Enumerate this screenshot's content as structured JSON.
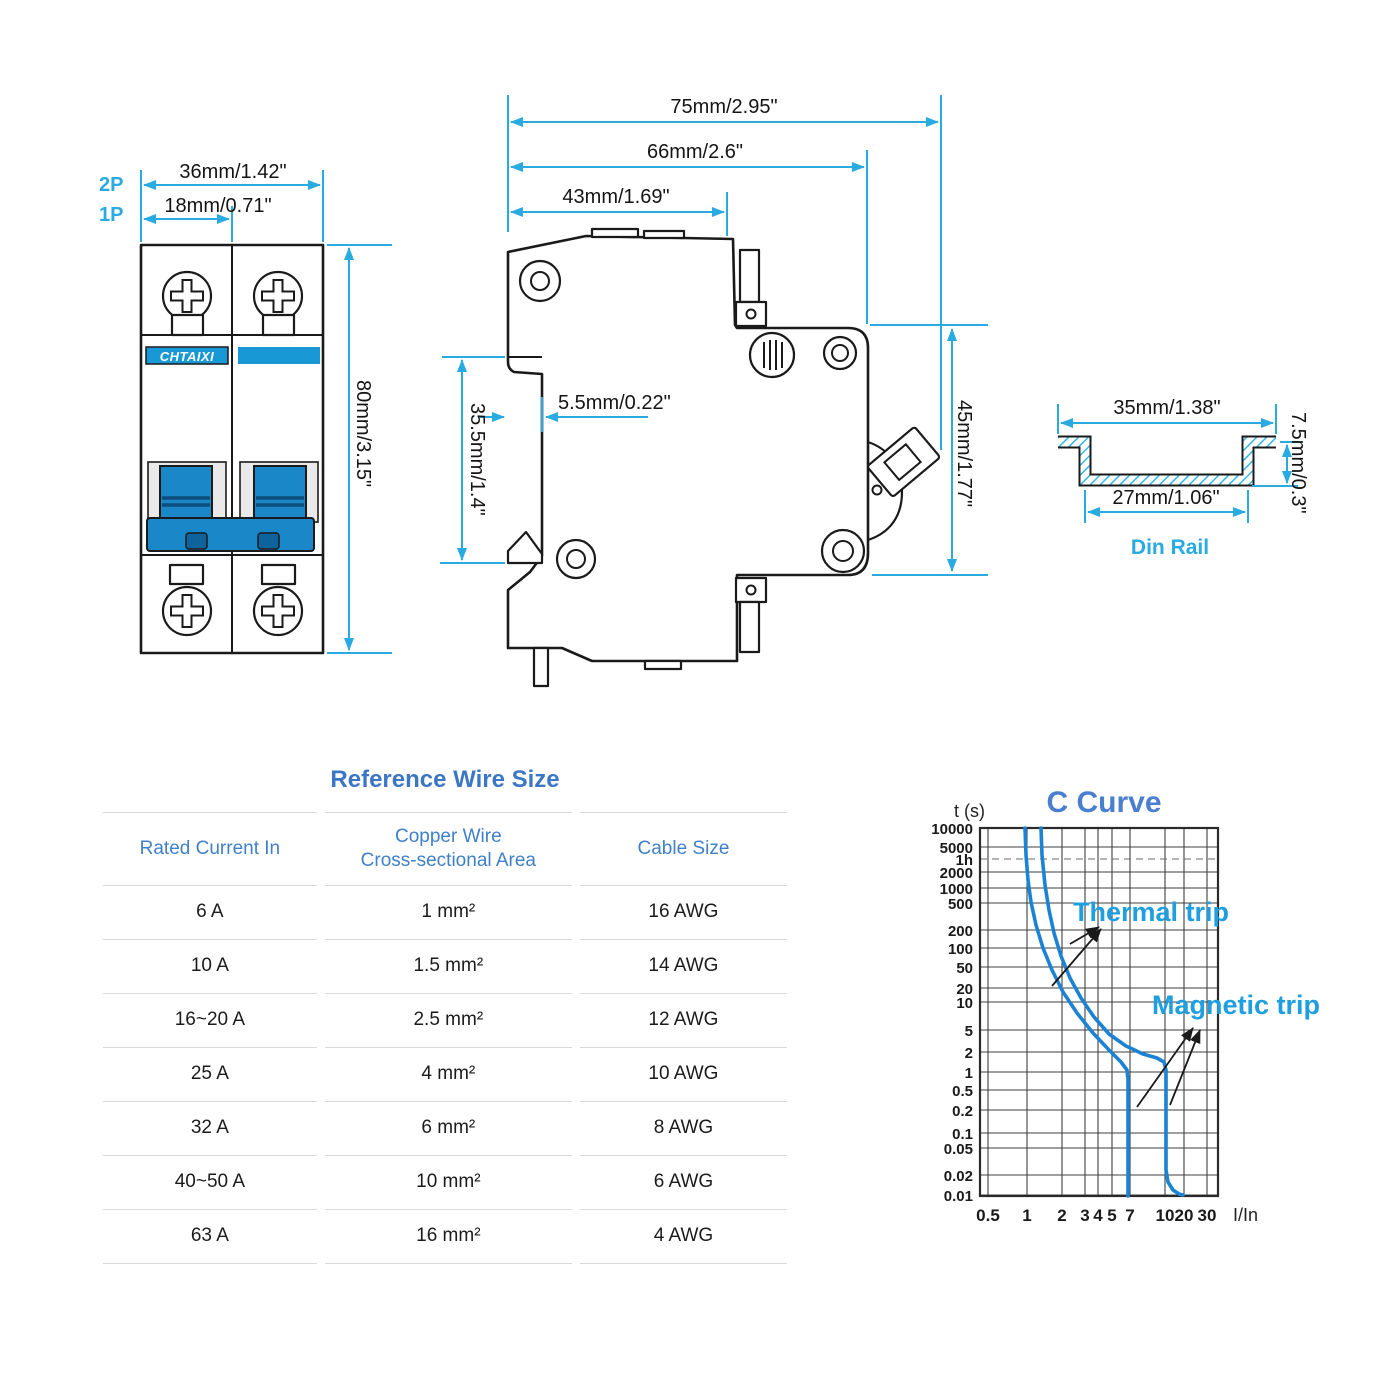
{
  "front_view": {
    "pole_labels": {
      "p2": "2P",
      "p1": "1P"
    },
    "brand": "CHTAIXI",
    "dims": {
      "width_2p": "36mm/1.42\"",
      "width_1p": "18mm/0.71\"",
      "height": "80mm/3.15\""
    }
  },
  "side_view": {
    "dims": {
      "total_width": "75mm/2.95\"",
      "body_width": "66mm/2.6\"",
      "front_width": "43mm/1.69\"",
      "recess_depth": "5.5mm/0.22\"",
      "recess_height": "35.5mm/1.4\"",
      "body_height": "45mm/1.77\""
    }
  },
  "din_rail": {
    "label": "Din Rail",
    "dims": {
      "outer_width": "35mm/1.38\"",
      "inner_width": "27mm/1.06\"",
      "depth": "7.5mm/0.3\""
    }
  },
  "wire_table": {
    "title": "Reference Wire Size",
    "headers": [
      "Rated Current In",
      "Copper Wire\nCross-sectional Area",
      "Cable Size"
    ],
    "rows": [
      [
        "6 A",
        "1 mm²",
        "16 AWG"
      ],
      [
        "10 A",
        "1.5 mm²",
        "14 AWG"
      ],
      [
        "16~20 A",
        "2.5 mm²",
        "12 AWG"
      ],
      [
        "25 A",
        "4 mm²",
        "10 AWG"
      ],
      [
        "32 A",
        "6 mm²",
        "8 AWG"
      ],
      [
        "40~50 A",
        "10 mm²",
        "6 AWG"
      ],
      [
        "63 A",
        "16 mm²",
        "4 AWG"
      ]
    ]
  },
  "chart_data": {
    "type": "line",
    "title": "C Curve",
    "ylabel": "t (s)",
    "xlabel": "I/In",
    "x_scale": "log",
    "y_scale": "log",
    "xlim": [
      0.5,
      40
    ],
    "ylim": [
      0.01,
      10000
    ],
    "grid": true,
    "annotations": [
      "Thermal trip",
      "Magnetic trip"
    ],
    "description": "MCB C-curve trip characteristic: tripping time vs multiples of rated current. Thermal trip region between the two curves; magnetic (instantaneous) trip between roughly 5x and 10x In.",
    "frame_px": {
      "x0": 980,
      "y0": 828,
      "x1": 1218,
      "y1": 1196
    },
    "x_ticks": [
      {
        "label": "0.5",
        "px": 988
      },
      {
        "label": "1",
        "px": 1027
      },
      {
        "label": "2",
        "px": 1062
      },
      {
        "label": "3",
        "px": 1085
      },
      {
        "label": "4",
        "px": 1098
      },
      {
        "label": "5",
        "px": 1112
      },
      {
        "label": "7",
        "px": 1130
      },
      {
        "label": "10",
        "px": 1165
      },
      {
        "label": "20",
        "px": 1184
      },
      {
        "label": "30",
        "px": 1207
      }
    ],
    "y_ticks": [
      {
        "label": "10000",
        "py": 828
      },
      {
        "label": "5000",
        "py": 847
      },
      {
        "label": "1h",
        "py": 859,
        "dashed": true
      },
      {
        "label": "2000",
        "py": 872
      },
      {
        "label": "1000",
        "py": 888
      },
      {
        "label": "500",
        "py": 903
      },
      {
        "label": "200",
        "py": 930
      },
      {
        "label": "100",
        "py": 948
      },
      {
        "label": "50",
        "py": 967
      },
      {
        "label": "20",
        "py": 988
      },
      {
        "label": "10",
        "py": 1002
      },
      {
        "label": "5",
        "py": 1030
      },
      {
        "label": "2",
        "py": 1052
      },
      {
        "label": "1",
        "py": 1072
      },
      {
        "label": "0.5",
        "py": 1090
      },
      {
        "label": "0.2",
        "py": 1110
      },
      {
        "label": "0.1",
        "py": 1133
      },
      {
        "label": "0.05",
        "py": 1148
      },
      {
        "label": "0.02",
        "py": 1175
      },
      {
        "label": "0.01",
        "py": 1195
      }
    ],
    "series": [
      {
        "name": "trip boundary lower (fast)",
        "approx_values": [
          [
            1,
            10000
          ],
          [
            1.3,
            1000
          ],
          [
            1.8,
            100
          ],
          [
            2.6,
            20
          ],
          [
            4,
            4
          ],
          [
            5.5,
            1
          ],
          [
            5.5,
            0.01
          ]
        ],
        "points_px": [
          [
            1025,
            828
          ],
          [
            1026,
            855
          ],
          [
            1028,
            880
          ],
          [
            1031,
            902
          ],
          [
            1036,
            925
          ],
          [
            1043,
            948
          ],
          [
            1052,
            970
          ],
          [
            1063,
            992
          ],
          [
            1077,
            1013
          ],
          [
            1093,
            1033
          ],
          [
            1109,
            1050
          ],
          [
            1121,
            1062
          ],
          [
            1127,
            1070
          ],
          [
            1128,
            1080
          ],
          [
            1128,
            1196
          ]
        ]
      },
      {
        "name": "trip boundary upper (slow)",
        "approx_values": [
          [
            1.35,
            10000
          ],
          [
            1.8,
            1000
          ],
          [
            2.6,
            100
          ],
          [
            4,
            20
          ],
          [
            6,
            6
          ],
          [
            9,
            2.6
          ],
          [
            10,
            2.2
          ],
          [
            10,
            0.02
          ],
          [
            11,
            0.01
          ]
        ],
        "points_px": [
          [
            1041,
            828
          ],
          [
            1042,
            855
          ],
          [
            1045,
            885
          ],
          [
            1049,
            910
          ],
          [
            1054,
            933
          ],
          [
            1061,
            956
          ],
          [
            1070,
            978
          ],
          [
            1081,
            998
          ],
          [
            1094,
            1017
          ],
          [
            1109,
            1034
          ],
          [
            1126,
            1046
          ],
          [
            1143,
            1054
          ],
          [
            1157,
            1058
          ],
          [
            1164,
            1062
          ],
          [
            1166,
            1070
          ],
          [
            1166,
            1170
          ],
          [
            1168,
            1182
          ],
          [
            1173,
            1190
          ],
          [
            1179,
            1194
          ],
          [
            1183,
            1195
          ]
        ]
      }
    ],
    "leaders": [
      [
        [
          1052,
          986
        ],
        [
          1101,
          929
        ]
      ],
      [
        [
          1070,
          944
        ],
        [
          1099,
          927
        ]
      ],
      [
        [
          1137,
          1107
        ],
        [
          1193,
          1028
        ]
      ],
      [
        [
          1170,
          1105
        ],
        [
          1200,
          1030
        ]
      ]
    ]
  },
  "colors": {
    "dimension_cyan": "#29abe2",
    "curve_blue": "#1c83d4",
    "annotation_blue": "#1f9fe0",
    "chart_title_blue": "#4a7fd0",
    "table_blue": "#3c77c5",
    "toggle_blue": "#1a87c8",
    "brand_strip_blue": "#1899d6"
  }
}
